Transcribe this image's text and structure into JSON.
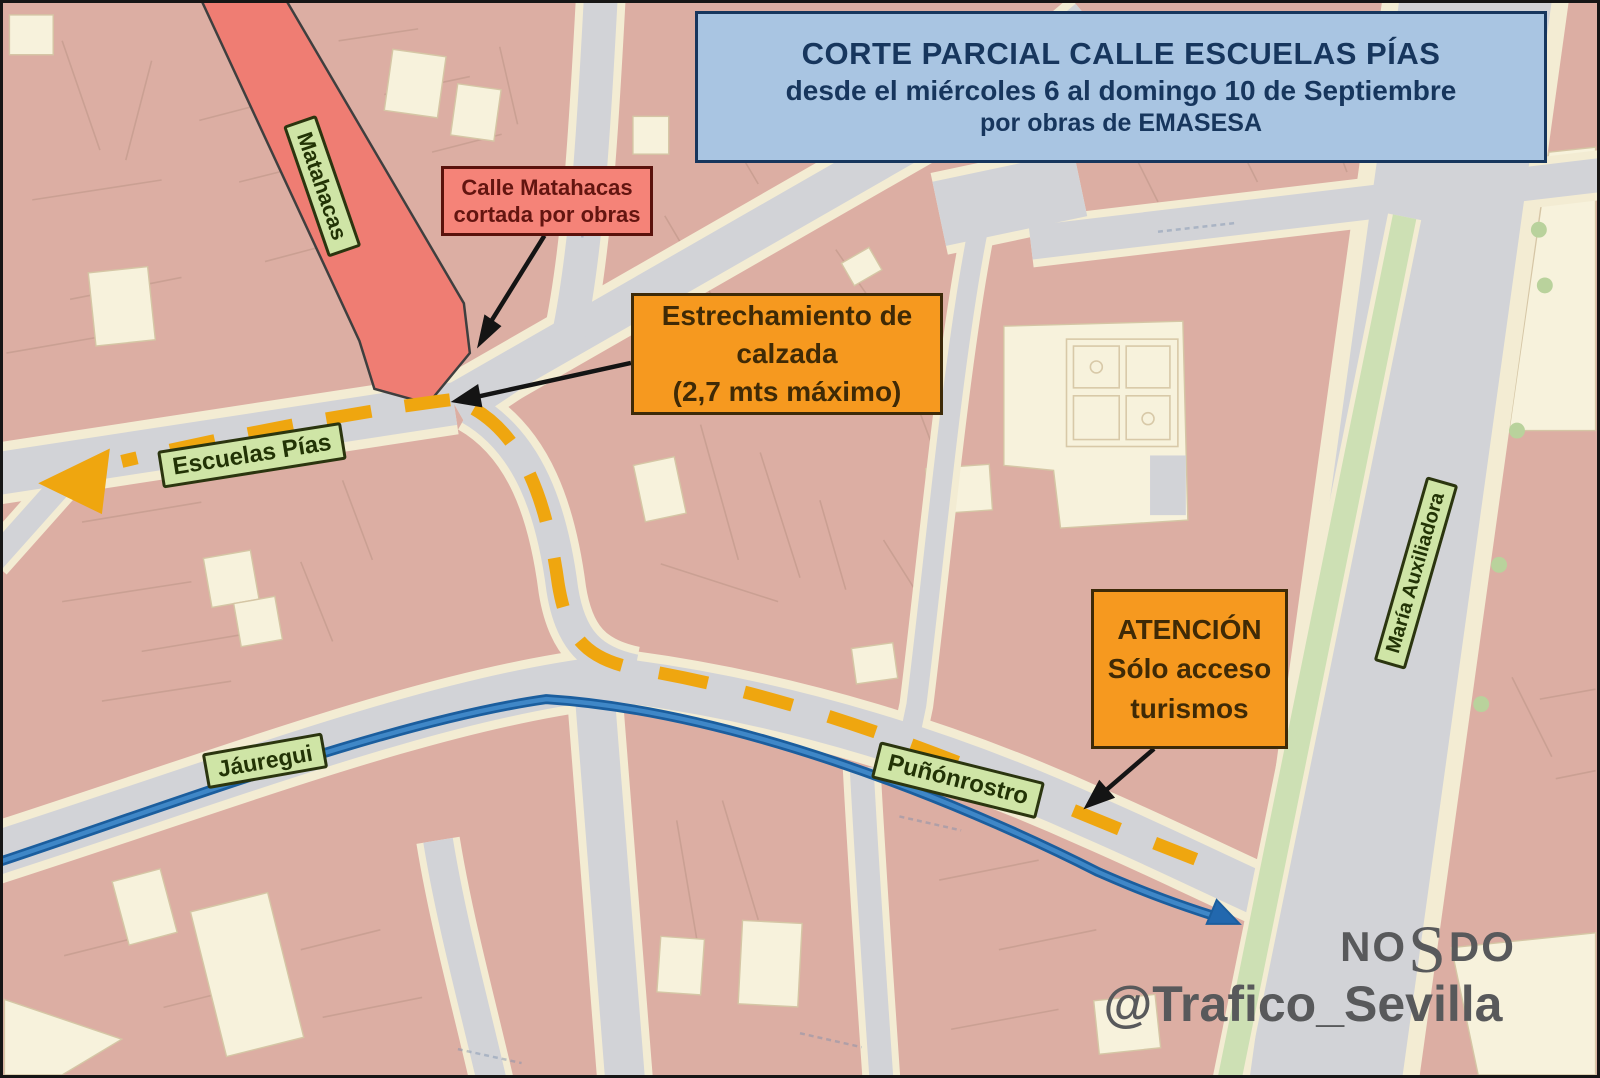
{
  "header": {
    "line1": "CORTE PARCIAL CALLE ESCUELAS PÍAS",
    "line2": "desde el miércoles 6 al domingo 10 de Septiembre",
    "line3": "por obras de EMASESA"
  },
  "annotations": {
    "matahacas_closed": {
      "line1": "Calle Matahacas",
      "line2": "cortada por obras"
    },
    "narrowing": {
      "line1": "Estrechamiento de",
      "line2": "calzada",
      "line3": "(2,7 mts máximo)"
    },
    "attention": {
      "line1": "ATENCIÓN",
      "line2": "Sólo acceso",
      "line3": "turismos"
    }
  },
  "street_labels": {
    "matahacas": "Matahacas",
    "escuelas_pias": "Escuelas Pías",
    "jauregui": "Jáuregui",
    "punonrostro": "Puñónrostro",
    "maria_auxiliadora": "María Auxiliadora"
  },
  "watermark": {
    "motto_left": "NO",
    "motto_mid": "S",
    "motto_right": "DO",
    "handle": "@Trafico_Sevilla"
  },
  "colors": {
    "header_bg": "#a9c5e2",
    "header_border": "#17365d",
    "alert_red_bg": "#f58378",
    "alert_red_border": "#5a120c",
    "alert_red_text": "#631510",
    "orange_bg": "#f6991f",
    "orange_border": "#3d2a08",
    "orange_text": "#3f2a06",
    "pill_bg": "#cfe5a6",
    "pill_border": "#2b350f",
    "pill_text": "#223305",
    "route_dash": "#efa60f",
    "route_blue": "#2268ae",
    "closed_street": "#ef7d73",
    "watermark_text": "#58595b"
  }
}
